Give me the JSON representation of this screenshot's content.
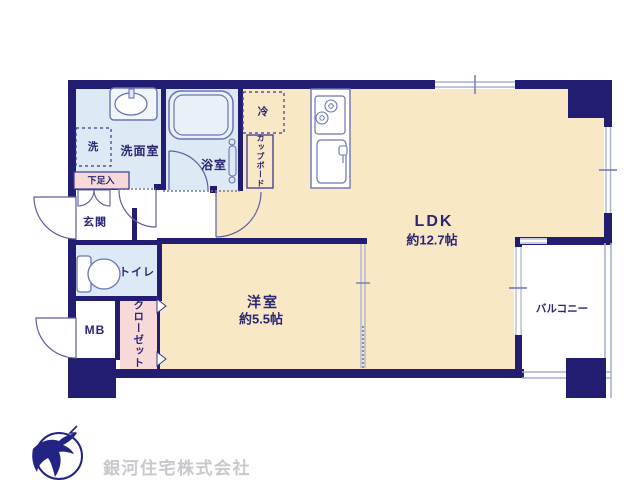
{
  "plan": {
    "rooms": {
      "ldk": {
        "label": "LDK",
        "area": "約12.7帖"
      },
      "western_room": {
        "label": "洋室",
        "area": "約5.5帖"
      },
      "balcony": {
        "label": "バルコニー"
      },
      "entrance": {
        "label": "玄関"
      },
      "toilet": {
        "label": "トイレ"
      },
      "washroom": {
        "label": "洗面室"
      },
      "bathroom": {
        "label": "浴室"
      },
      "meter_box": {
        "label": "MB"
      },
      "closet": {
        "label": "クローゼット"
      },
      "cupboard": {
        "label": "カップボード"
      },
      "shoe_cabinet": {
        "label": "下足入"
      },
      "washer": {
        "label": "洗"
      },
      "refrigerator": {
        "label": "冷"
      }
    },
    "branding": {
      "company": "銀河住宅株式会社",
      "logo_icon": "bird-logo-icon"
    },
    "colors": {
      "wall_navy": "#221d70",
      "floor_main_cream": "#f9e8c5",
      "floor_wet_blue": "#dde9f4",
      "closet_pink": "#f7d9d8",
      "fixture_line": "#6b74b3",
      "railing_lavender": "#aab0d4",
      "label_navy": "#2b2673",
      "brand_navy": "#232383",
      "brand_text_gray": "#c8c8cd"
    }
  }
}
